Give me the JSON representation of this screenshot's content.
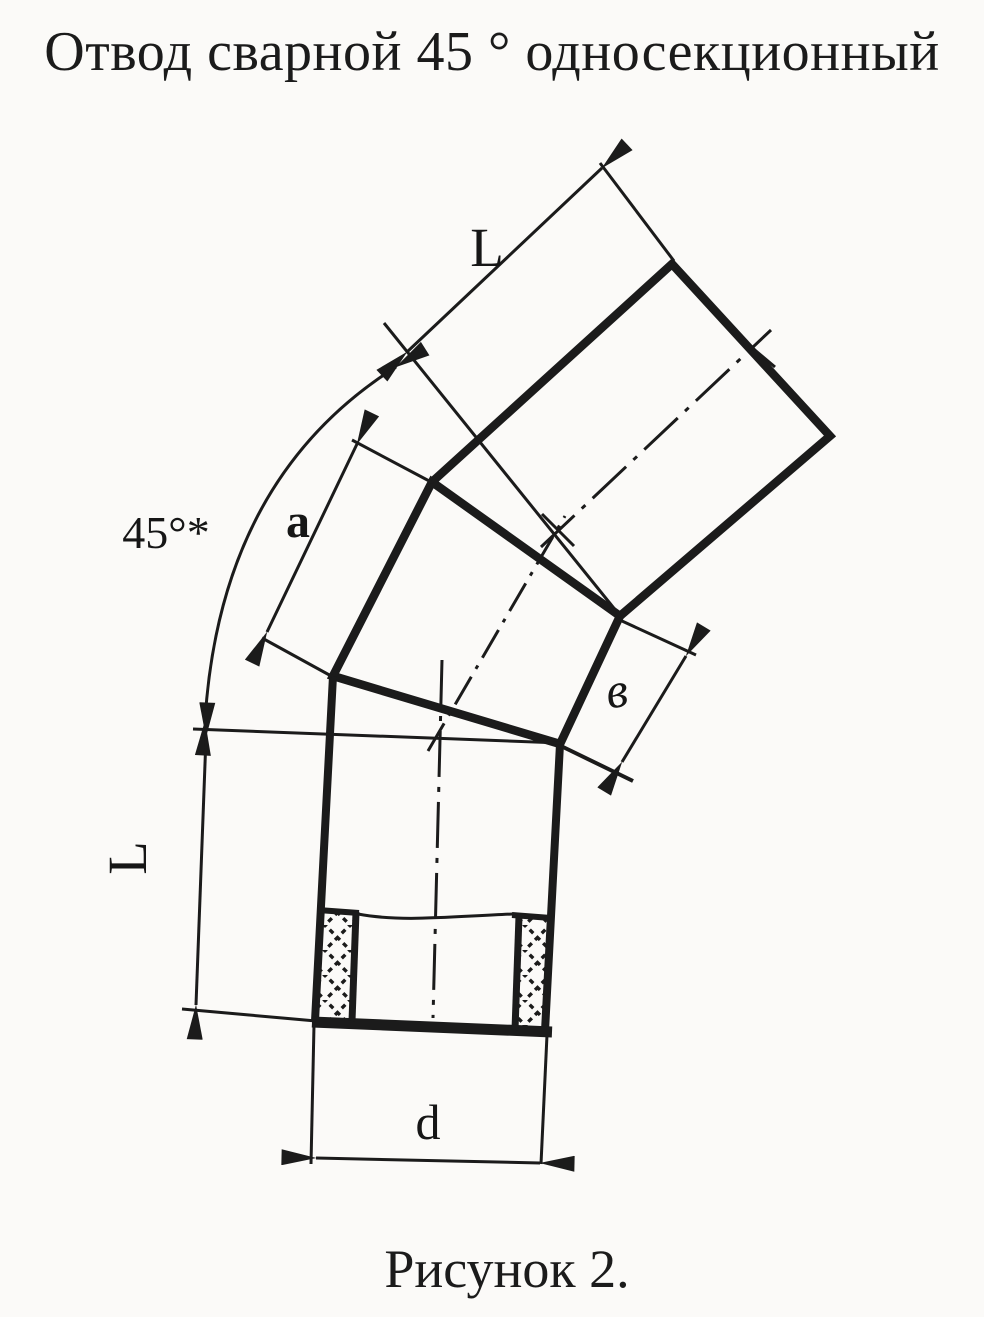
{
  "title": "Отвод сварной 45 ° односекционный",
  "caption": "Рисунок 2.",
  "labels": {
    "top_length": "L",
    "angle": "45°*",
    "segment_length": "a",
    "face_width": "в",
    "left_length": "L",
    "diameter": "d"
  },
  "colors": {
    "ink": "#1b1b1b",
    "paper": "#fbfaf8"
  }
}
